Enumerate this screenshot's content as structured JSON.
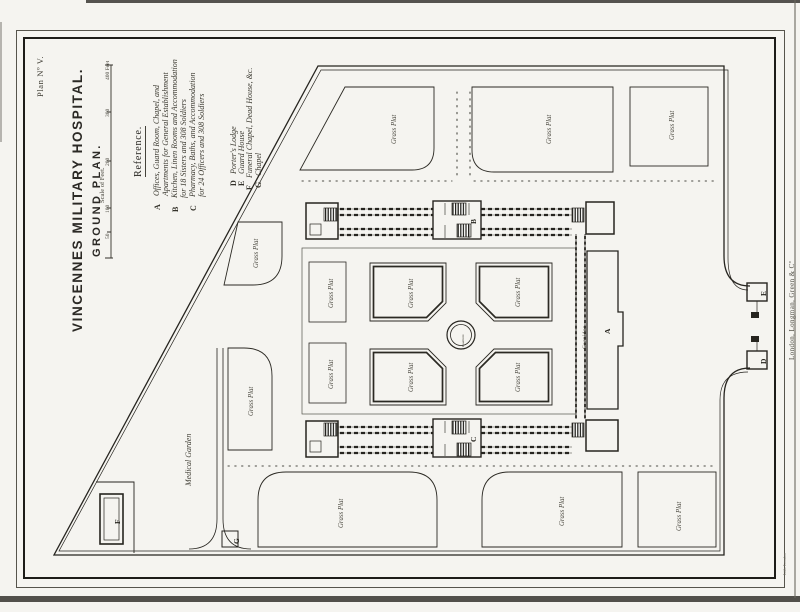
{
  "page": {
    "plan_number": "Plan Nº V."
  },
  "title_block": {
    "title": "VINCENNES MILITARY HOSPITAL.",
    "subtitle": "GROUND PLAN."
  },
  "scale": {
    "caption": "Scale of Feet.",
    "ticks": [
      "50",
      "100",
      "200",
      "300",
      "400 Feet"
    ]
  },
  "reference": {
    "heading": "Reference.",
    "items": [
      {
        "letter": "A",
        "lines": [
          "Offices, Guard Room, Chapel, and",
          "Apartments for General Establishment"
        ]
      },
      {
        "letter": "B",
        "lines": [
          "Kitchen, Linen Rooms and Accommodation",
          "for 18 Sisters and 308 Soldiers"
        ]
      },
      {
        "letter": "C",
        "lines": [
          "Pharmacy, Baths, and Accommodation",
          "for 24 Officers and 308 Soldiers"
        ]
      },
      {
        "letter": "D",
        "lines": [
          "Porter's Lodge"
        ]
      },
      {
        "letter": "E",
        "lines": [
          "Guard House"
        ]
      },
      {
        "letter": "F",
        "lines": [
          "Funeral Chapel, Dead House, &c."
        ]
      },
      {
        "letter": "G",
        "lines": [
          "Chapel"
        ]
      }
    ]
  },
  "plan_labels": {
    "grass_plat": "Grass Plat",
    "medical_garden": "Medical Garden",
    "fountain": "Fountain",
    "corridor": "Corridor",
    "building_a": "A",
    "building_b": "B",
    "building_c": "C",
    "building_d": "D",
    "building_e": "E",
    "building_f": "F",
    "building_g": "G"
  },
  "imprints": {
    "publisher": "London, Longman, Green & Cº",
    "lithographer": "Lith. London"
  },
  "colors": {
    "ink": "#26241f",
    "paper": "#f5f4f0"
  }
}
